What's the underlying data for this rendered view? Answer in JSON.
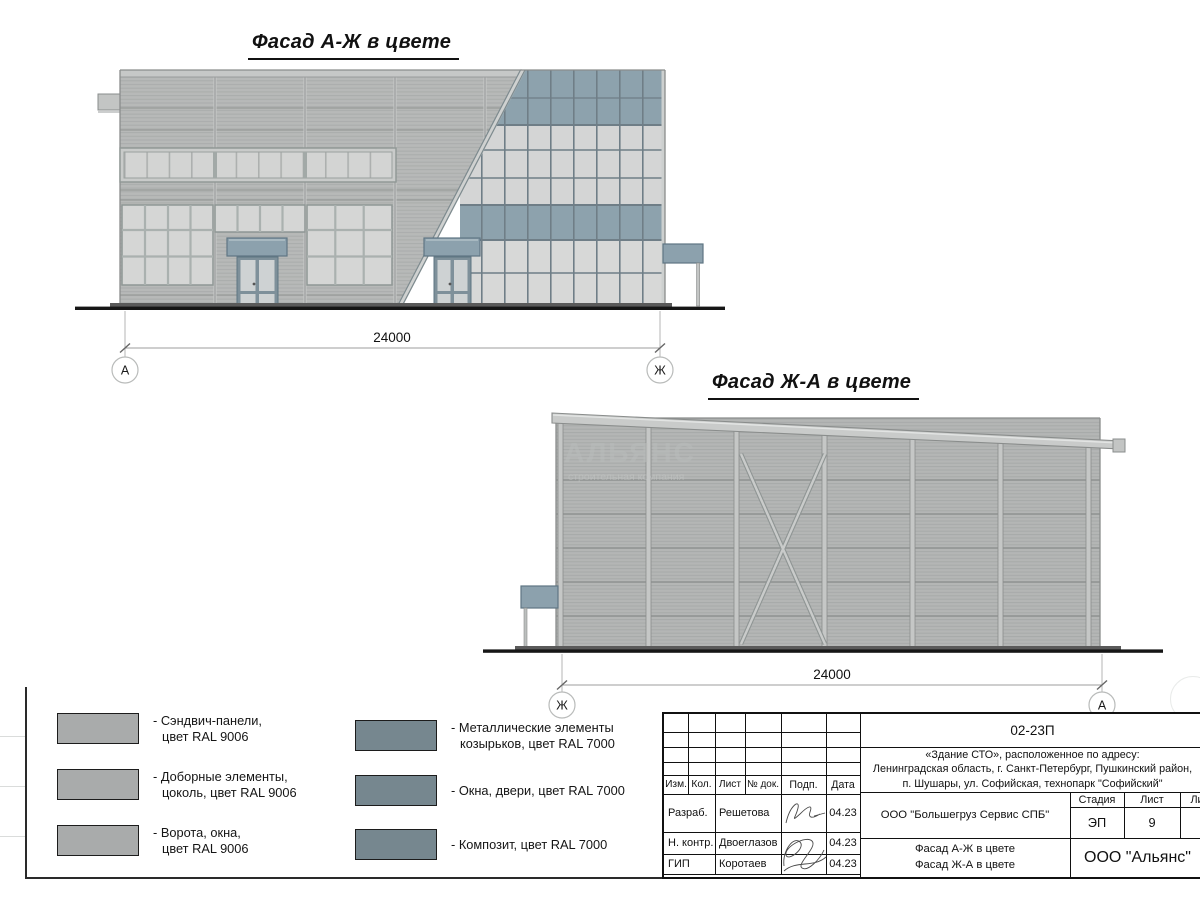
{
  "facade1": {
    "title": "Фасад А-Ж в цвете",
    "dimension": "24000",
    "axis_left": "А",
    "axis_right": "Ж"
  },
  "facade2": {
    "title": "Фасад Ж-А в цвете",
    "dimension": "24000",
    "axis_left": "Ж",
    "axis_right": "А",
    "watermark_line1": "АЛЬЯНС",
    "watermark_line2": "строительная компания"
  },
  "legend": {
    "ral9006_color": "#a9abab",
    "ral7000_color": "#76878f",
    "items": [
      {
        "line1": "- Сэндвич-панели,",
        "line2": "цвет RAL 9006"
      },
      {
        "line1": "- Доборные элементы,",
        "line2": "цоколь, цвет RAL 9006"
      },
      {
        "line1": "- Ворота, окна,",
        "line2": "цвет RAL 9006"
      },
      {
        "line1": "- Металлические элементы",
        "line2": "козырьков, цвет RAL 7000"
      },
      {
        "line1": "- Окна, двери, цвет RAL 7000",
        "line2": ""
      },
      {
        "line1": "- Композит, цвет RAL 7000",
        "line2": ""
      }
    ]
  },
  "titleblock": {
    "doc_number": "02-23П",
    "address_line1": "«Здание СТО», расположенное по адресу:",
    "address_line2": "Ленинградская область, г. Санкт-Петербург, Пушкинский район,",
    "address_line3": "п. Шушары, ул. Софийская, технопарк \"Софийский\"",
    "col_izm": "Изм.",
    "col_kol": "Кол.",
    "col_list": "Лист",
    "col_ndok": "№ док.",
    "col_podp": "Подп.",
    "col_data": "Дата",
    "row1_role": "Разраб.",
    "row1_name": "Решетова",
    "row1_date": "04.23",
    "row2_role": "Н. контр.",
    "row2_name": "Двоеглазов",
    "row2_date": "04.23",
    "row3_role": "ГИП",
    "row3_name": "Коротаев",
    "row3_date": "04.23",
    "customer": "ООО \"Большегруз Сервис СПБ\"",
    "stage_label": "Стадия",
    "sheet_label": "Лист",
    "sheets_label": "Листов",
    "stage_value": "ЭП",
    "sheet_value": "9",
    "sheets_value": "21",
    "sheet_title_line1": "Фасад А-Ж в цвете",
    "sheet_title_line2": "Фасад Ж-А в цвете",
    "company": "ООО \"Альянс\""
  }
}
